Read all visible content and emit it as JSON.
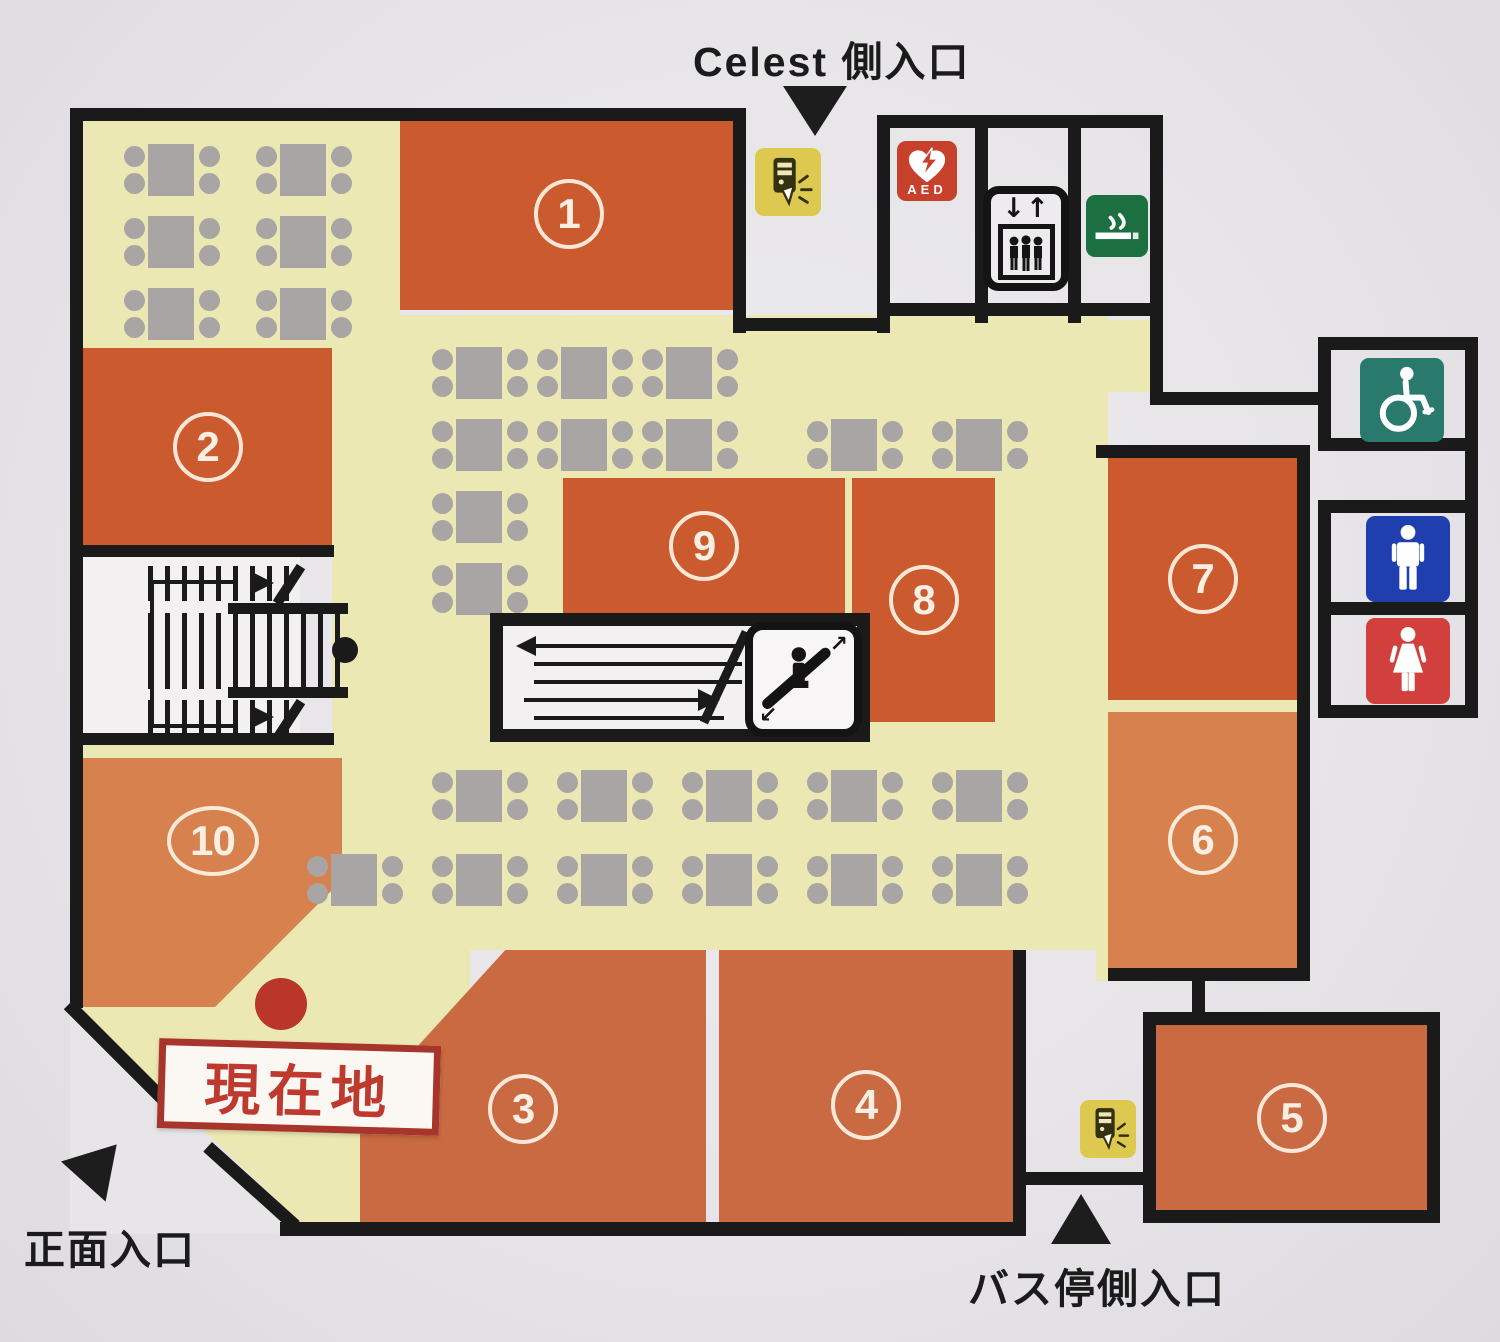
{
  "entrances": {
    "celest": "Celest 側入口",
    "front": "正面入口",
    "bus": "バス停側入口"
  },
  "current_location": "現在地",
  "zones": {
    "z1": "1",
    "z2": "2",
    "z3": "3",
    "z4": "4",
    "z5": "5",
    "z6": "6",
    "z7": "7",
    "z8": "8",
    "z9": "9",
    "z10": "10"
  },
  "aed_label": "AED",
  "icons": {
    "top_corridor": "vending-machine",
    "aed": "aed-defibrillator",
    "elevator": "elevator",
    "smoking": "smoking-area",
    "accessible": "wheelchair-accessible-toilet",
    "mens": "mens-toilet",
    "womens": "womens-toilet",
    "bus_corridor": "vending-machine",
    "stairs": "staircase",
    "escalator": "escalator"
  },
  "colors": {
    "floor": "#ece8b3",
    "wall": "#1a1a1a",
    "table": "#a9a5a4",
    "zone_dark": "#cb5a2e",
    "zone_mid": "#c96a42",
    "zone_light": "#d6814e",
    "current_red": "#b93629",
    "sign_red": "#bf3a2e",
    "aed_red": "#c7402c",
    "smoking_green": "#1b6f41",
    "accessible_teal": "#29796c",
    "mens_blue": "#1f3fae",
    "womens_red": "#d2403e",
    "vending_yellow": "#ddc94f"
  }
}
